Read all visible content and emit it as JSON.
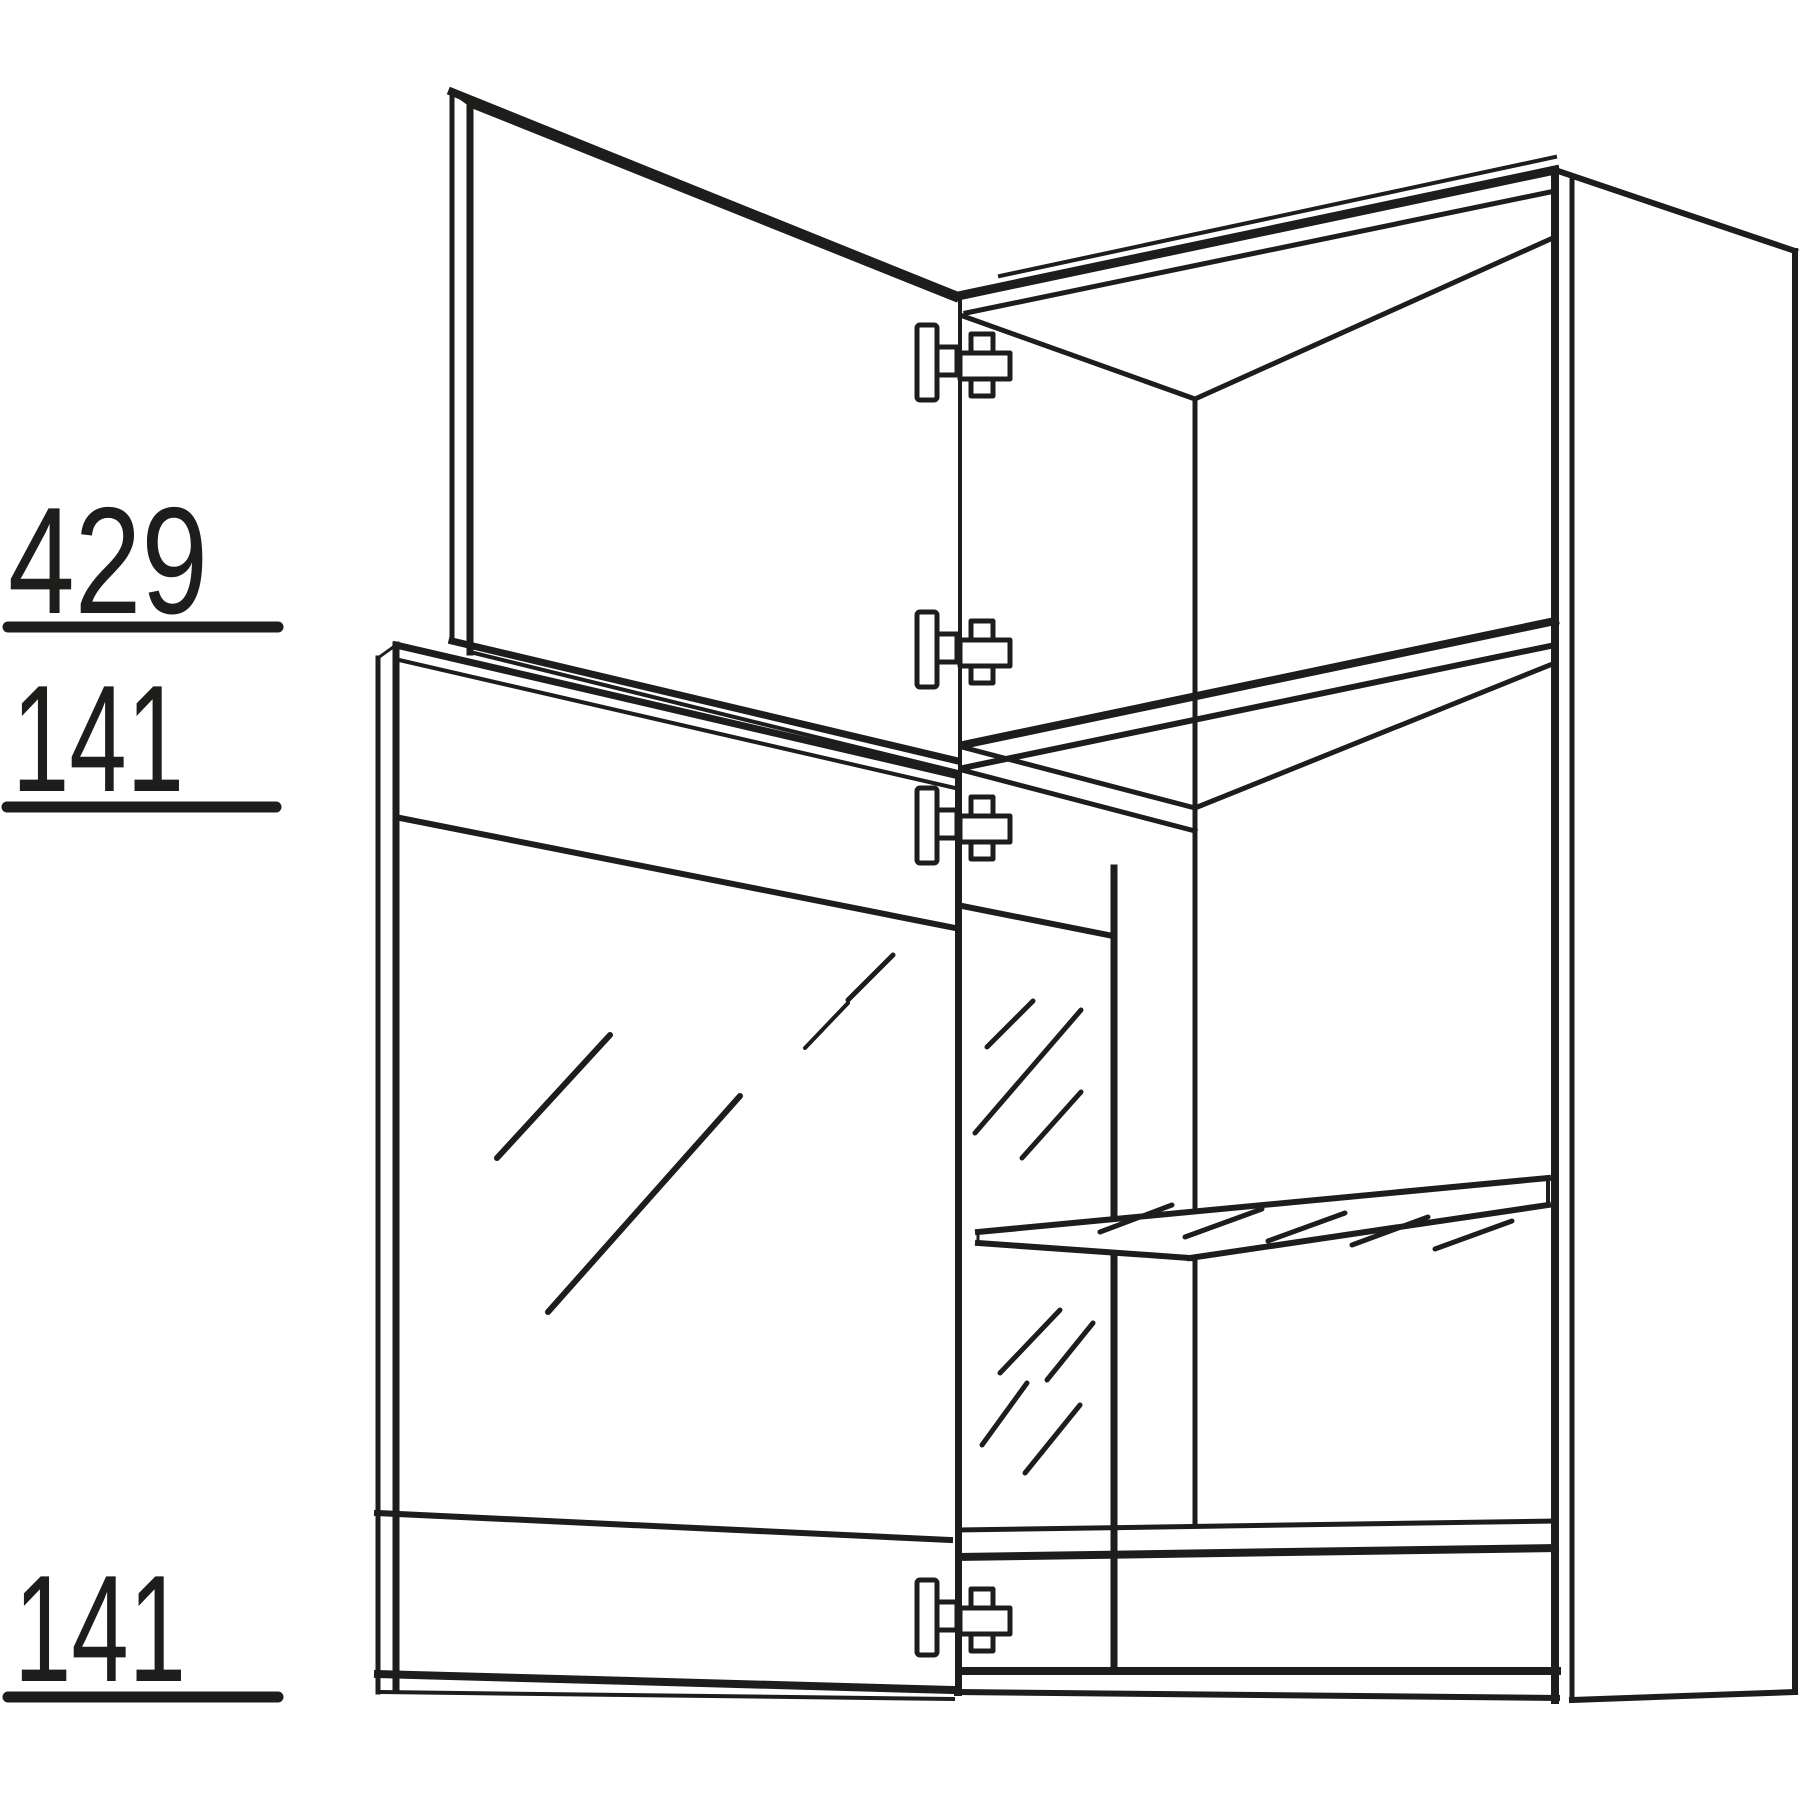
{
  "diagram": {
    "type": "furniture-technical-line-drawing",
    "subject": "wall cabinet with open solid upper door, open glass door, glass side panel and glass shelf",
    "background_color": "#ffffff",
    "line_color": "#1d1d1b",
    "dimensions": [
      {
        "part": "upper-door-height",
        "value": "429"
      },
      {
        "part": "glass-door-top-rail-height",
        "value": "141"
      },
      {
        "part": "glass-door-bottom-rail-height",
        "value": "141"
      }
    ],
    "hinge_count": 4,
    "glass_elements": [
      "glass-door-pane",
      "glass-side-panel",
      "glass-shelf"
    ]
  }
}
